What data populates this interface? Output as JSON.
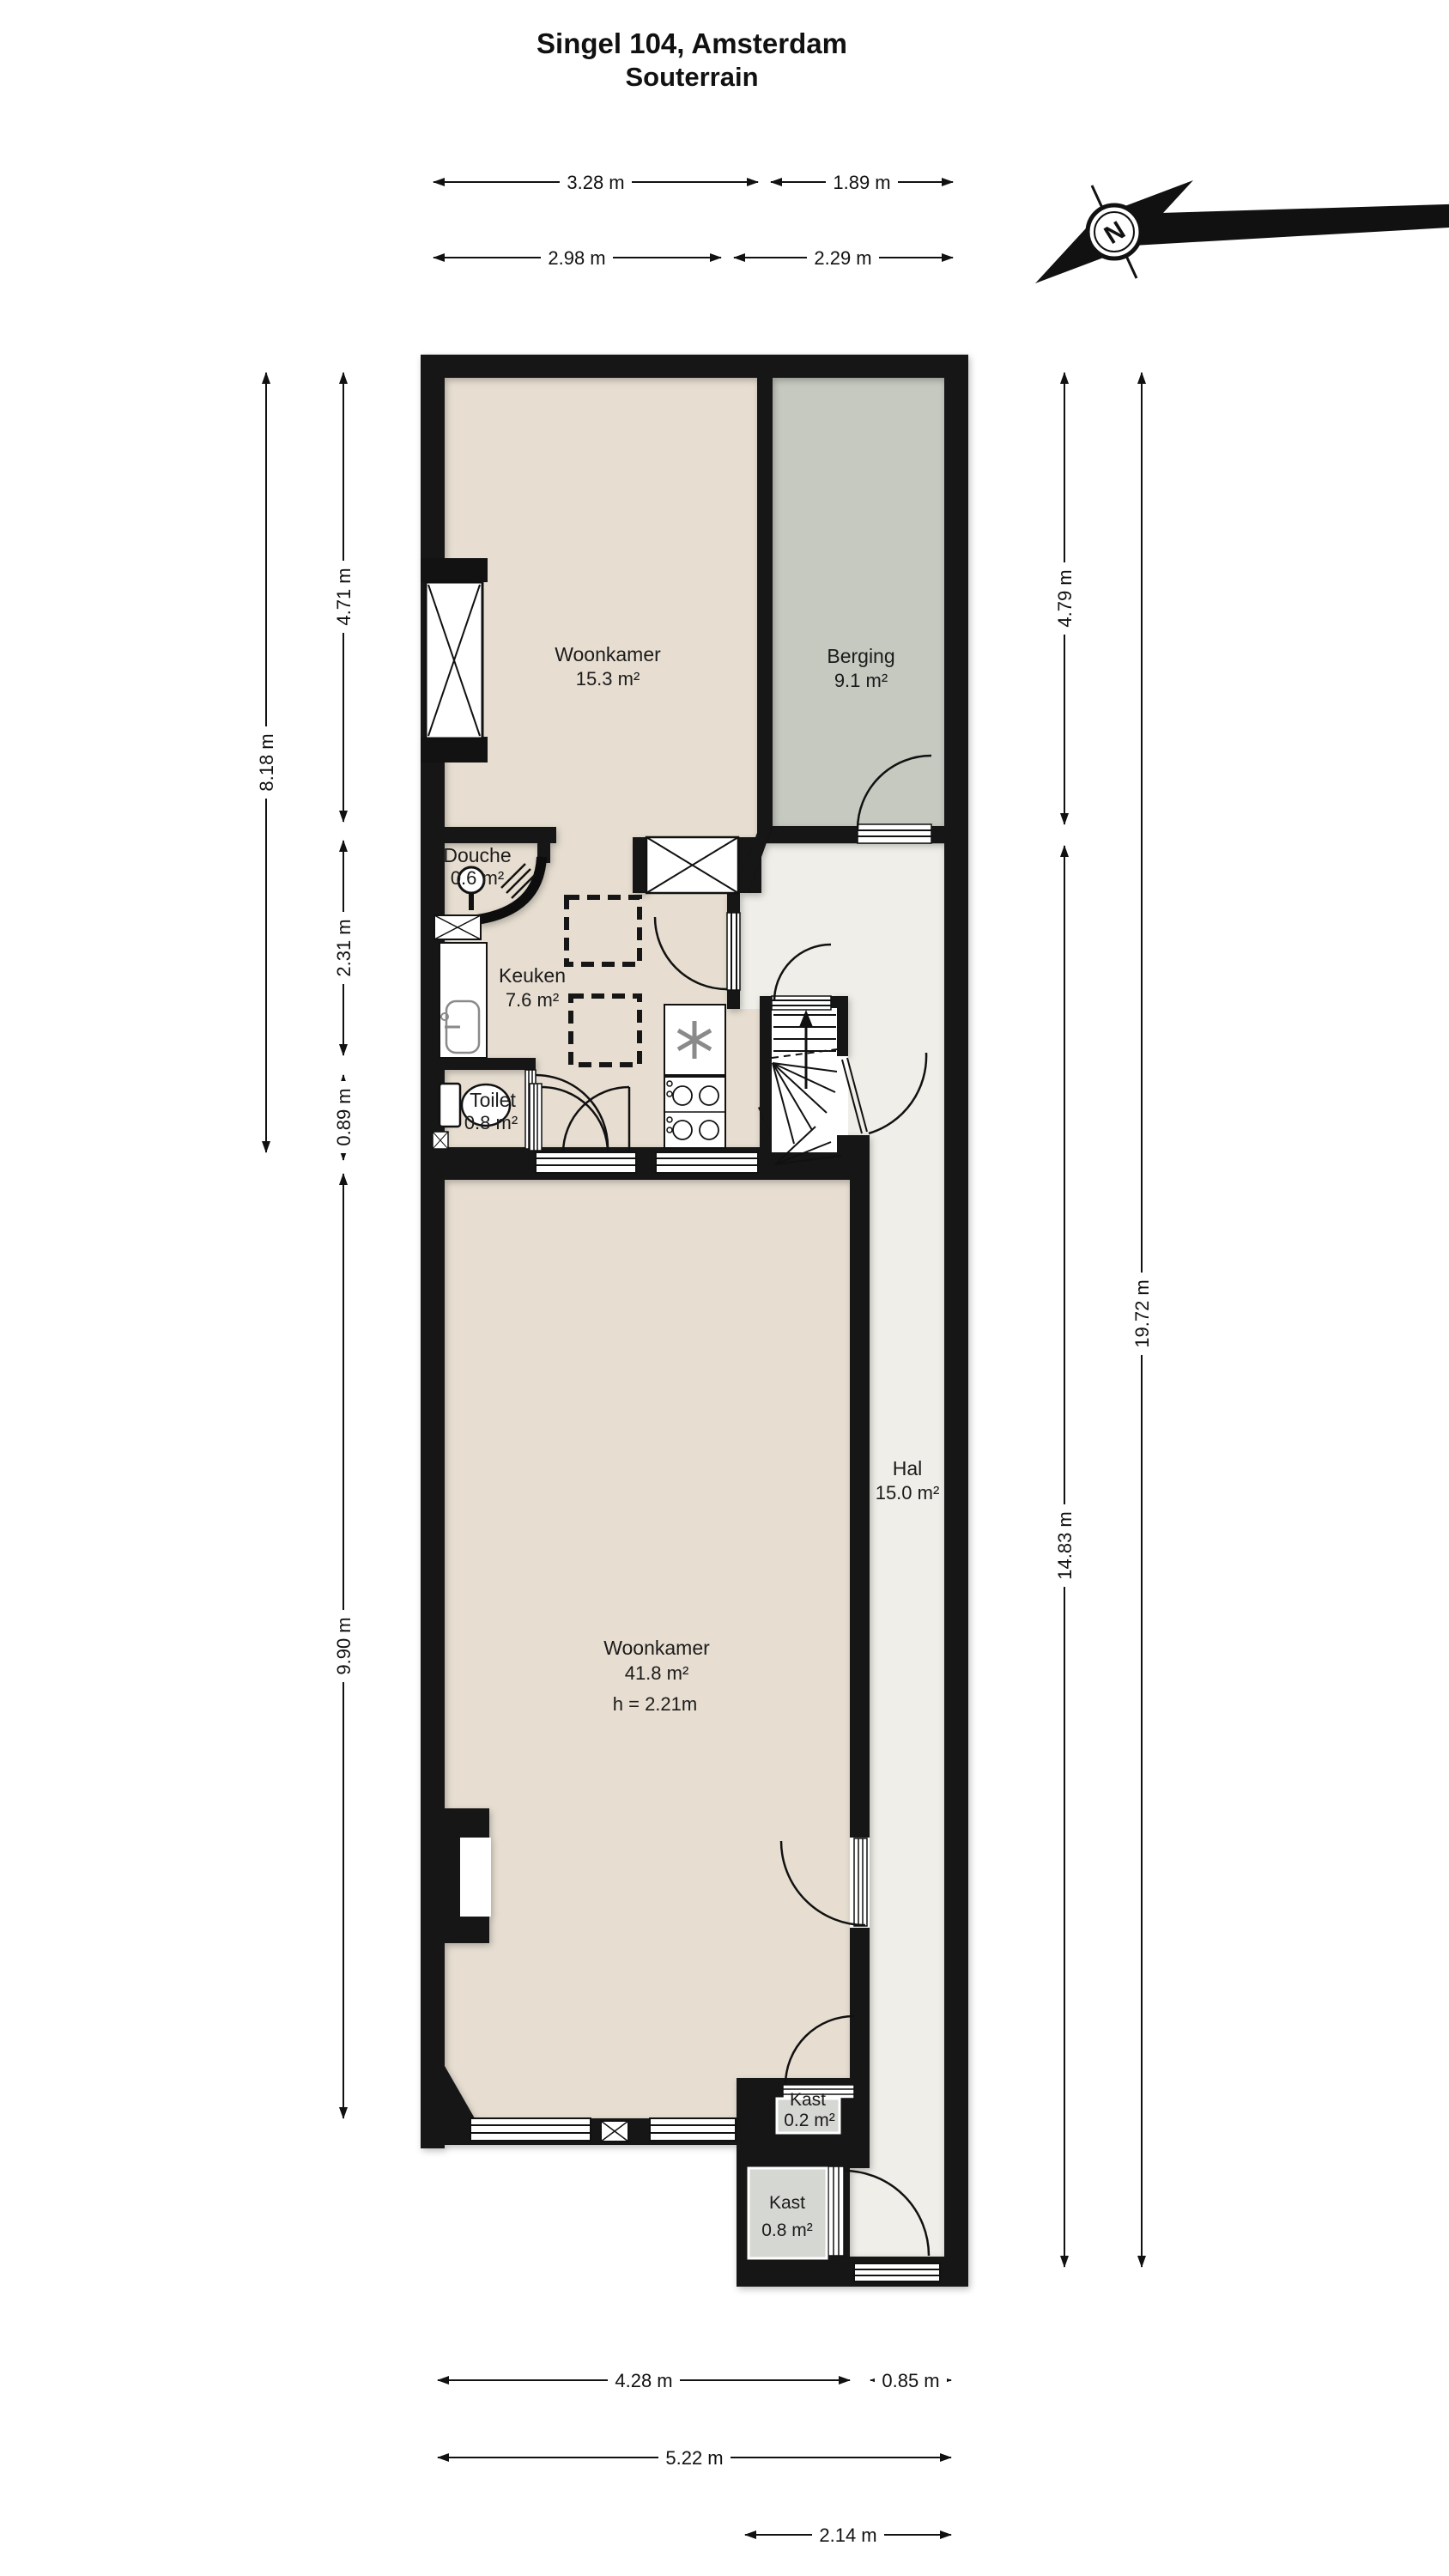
{
  "title": {
    "line1": "Singel 104, Amsterdam",
    "line2": "Souterrain"
  },
  "compass": {
    "north_label": "N"
  },
  "rooms": {
    "woonkamer_top": {
      "name": "Woonkamer",
      "area": "15.3 m²"
    },
    "berging": {
      "name": "Berging",
      "area": "9.1 m²"
    },
    "douche": {
      "name": "Douche",
      "area": "0.6 m²"
    },
    "keuken": {
      "name": "Keuken",
      "area": "7.6 m²"
    },
    "toilet": {
      "name": "Toilet",
      "area": "0.8 m²"
    },
    "hal": {
      "name": "Hal",
      "area": "15.0 m²"
    },
    "woonkamer_main": {
      "name": "Woonkamer",
      "area": "41.8 m²",
      "ceiling_height": "h = 2.21m"
    },
    "kast_small": {
      "name": "Kast",
      "area": "0.2 m²"
    },
    "kast_large": {
      "name": "Kast",
      "area": "0.8 m²"
    }
  },
  "dimensions": {
    "top": [
      "3.28 m",
      "1.89 m",
      "2.98 m",
      "2.29 m"
    ],
    "left": [
      "8.18 m",
      "4.71 m",
      "2.31 m",
      "0.89 m",
      "9.90 m"
    ],
    "right": [
      "4.79 m",
      "14.83 m",
      "19.72 m"
    ],
    "bottom": [
      "4.28 m",
      "0.85 m",
      "5.22 m",
      "2.14 m"
    ]
  },
  "colors": {
    "wall": "#121212",
    "room_beige": "#e7ded1",
    "berging_green": "#c5c9c0",
    "hal_light": "#efeee8",
    "kast_gray": "#d5d7d2"
  }
}
